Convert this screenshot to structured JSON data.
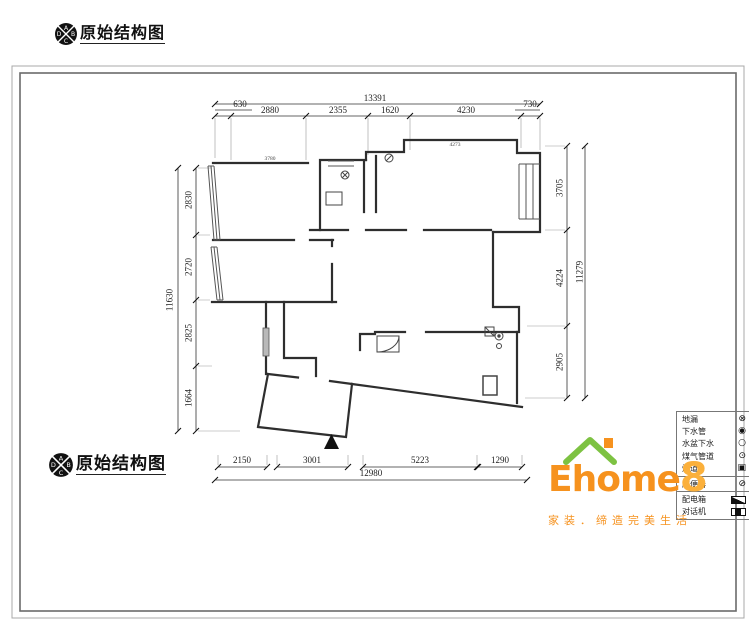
{
  "drawing": {
    "title": "原始结构图",
    "compass_letters": {
      "top": "A",
      "left": "D",
      "right": "B",
      "bottom": "C"
    }
  },
  "dimensions": {
    "top": {
      "total": "13391",
      "segments": [
        "630",
        "2880",
        "2355",
        "1620",
        "4230",
        "730"
      ]
    },
    "left": {
      "total": "11630",
      "segments": [
        "2830",
        "2720",
        "2825",
        "1664"
      ]
    },
    "right": {
      "total": "11279",
      "segments": [
        "3705",
        "4224",
        "2905"
      ]
    },
    "bottom": {
      "total": "12980",
      "segments": [
        "2150",
        "3001",
        "5223",
        "1290"
      ]
    }
  },
  "plan_annotations": {
    "wall_dim_1": "3780",
    "wall_dim_2": "4273"
  },
  "legend": {
    "items": [
      {
        "label": "地漏"
      },
      {
        "label": "下水管"
      },
      {
        "label": "水盆下水"
      },
      {
        "label": "煤气管道"
      },
      {
        "label": "烟道"
      },
      {
        "label": "座便器"
      },
      {
        "label": "配电箱"
      },
      {
        "label": "对话机"
      }
    ]
  },
  "brand": {
    "name": "Ehome",
    "suffix": "8",
    "tagline": "家装．缔造完美生活",
    "colors": {
      "green": "#7DC242",
      "orange": "#F6921E",
      "light_orange": "#FBB03B"
    }
  }
}
